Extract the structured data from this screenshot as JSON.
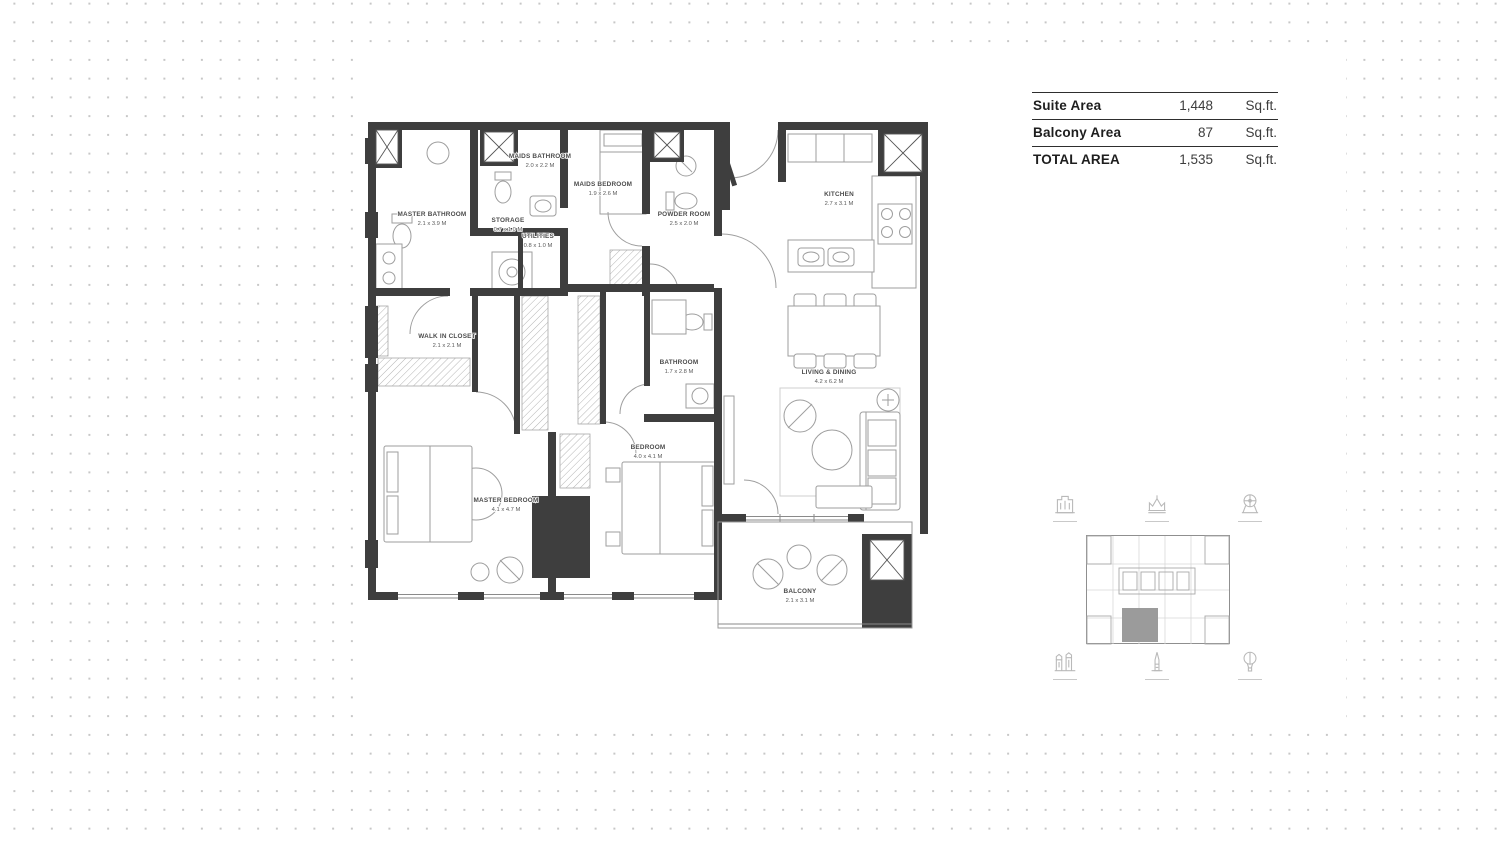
{
  "area_table": {
    "rows": [
      {
        "label": "Suite Area",
        "value": "1,448",
        "unit": "Sq.ft."
      },
      {
        "label": "Balcony Area",
        "value": "87",
        "unit": "Sq.ft."
      },
      {
        "label": "TOTAL AREA",
        "value": "1,535",
        "unit": "Sq.ft."
      }
    ]
  },
  "floorplan": {
    "rooms": [
      {
        "name": "MASTER BATHROOM",
        "dims": "2.1 x 3.9 M"
      },
      {
        "name": "MAIDS BATHROOM",
        "dims": "2.0 x 2.2 M"
      },
      {
        "name": "MAIDS BEDROOM",
        "dims": "1.9 x 2.6 M"
      },
      {
        "name": "STORAGE",
        "dims": "0.7 x 1.0 M"
      },
      {
        "name": "UTILITIES",
        "dims": "0.8 x 1.0 M"
      },
      {
        "name": "POWDER ROOM",
        "dims": "2.5 x 2.0 M"
      },
      {
        "name": "KITCHEN",
        "dims": "2.7 x 3.1 M"
      },
      {
        "name": "WALK IN CLOSET",
        "dims": "2.1 x 2.1 M"
      },
      {
        "name": "BATHROOM",
        "dims": "1.7 x 2.8 M"
      },
      {
        "name": "LIVING & DINING",
        "dims": "4.2 x 6.2 M"
      },
      {
        "name": "BEDROOM",
        "dims": "4.0 x 4.1 M"
      },
      {
        "name": "MASTER BEDROOM",
        "dims": "4.1 x 4.7 M"
      },
      {
        "name": "BALCONY",
        "dims": "2.1 x 3.1 M"
      }
    ]
  },
  "colors": {
    "wall": "#3e3e3e",
    "furniture_line": "#9e9e9e",
    "label_text": "#4c4c4c",
    "dot": "#c7c7c7",
    "keyplan_highlight": "#9b9b9b",
    "icon": "#b9b9b9",
    "table_line": "#2e2e2e"
  }
}
